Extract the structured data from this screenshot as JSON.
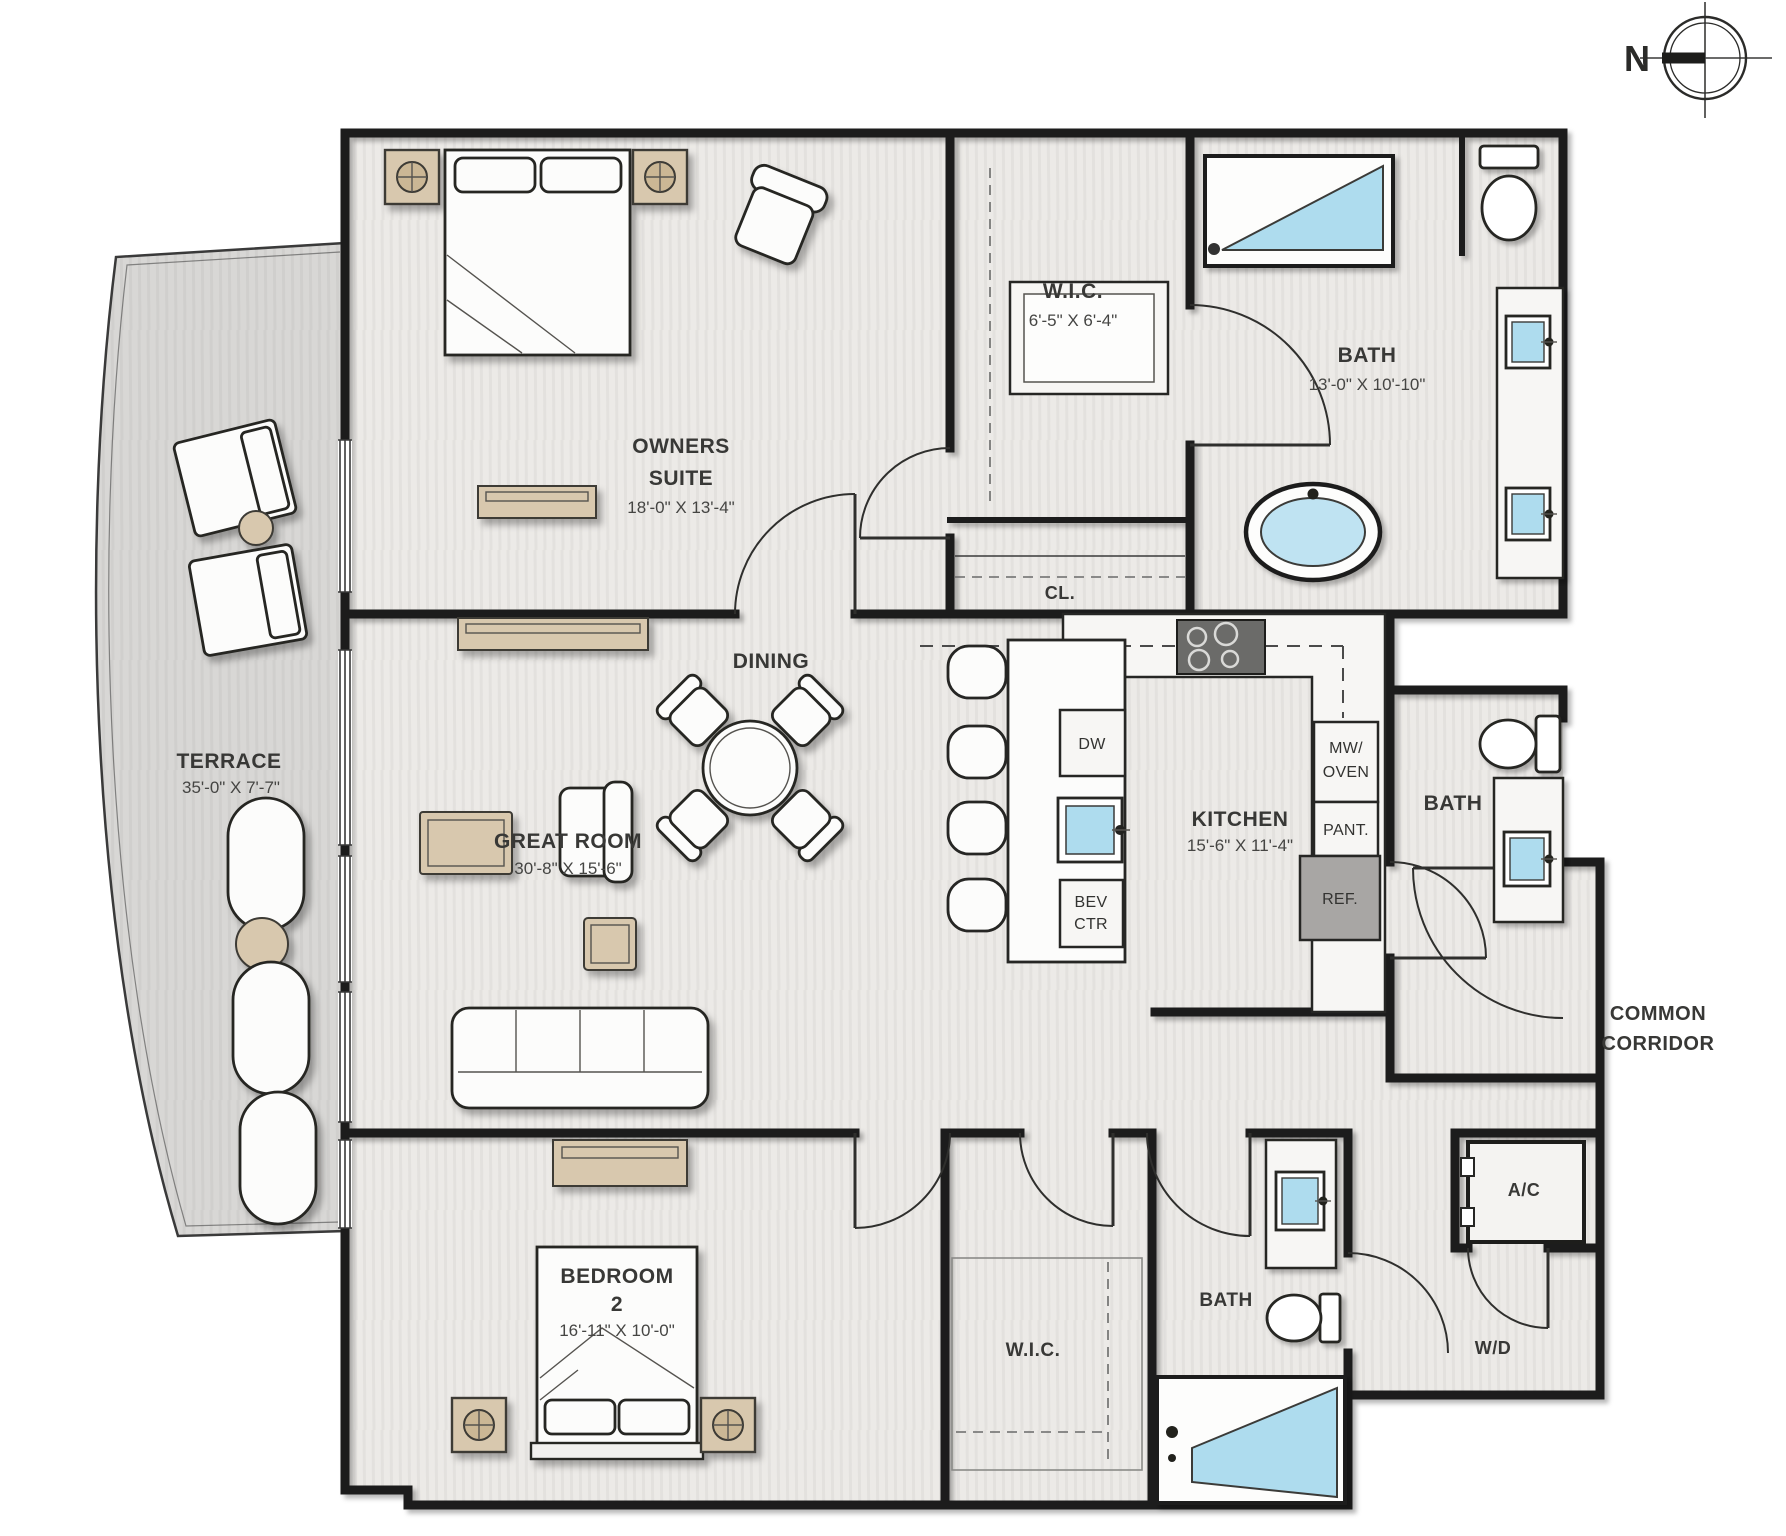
{
  "plan": {
    "compass": {
      "north": "N"
    },
    "rooms": {
      "owners_suite": {
        "line1": "OWNERS",
        "line2": "SUITE",
        "dims": "18'-0\" X 13'-4\""
      },
      "owners_wic": {
        "name": "W.I.C.",
        "dims": "6'-5\" X 6'-4\""
      },
      "owners_bath": {
        "name": "BATH",
        "dims": "13'-0\" X 10'-10\""
      },
      "closet": {
        "name": "CL."
      },
      "dining": {
        "name": "DINING"
      },
      "great_room": {
        "name": "GREAT ROOM",
        "dims": "30'-8\" X 15'-6\""
      },
      "terrace": {
        "name": "TERRACE",
        "dims": "35'-0\" X 7'-7\""
      },
      "kitchen": {
        "name": "KITCHEN",
        "dims": "15'-6\" X 11'-4\""
      },
      "powder_bath": {
        "name": "BATH"
      },
      "bedroom_2": {
        "line1": "BEDROOM",
        "line2": "2",
        "dims": "16'-11\" X 10'-0\""
      },
      "bedroom_wic": {
        "name": "W.I.C."
      },
      "bedroom_bath": {
        "name": "BATH"
      },
      "ac_closet": {
        "name": "A/C"
      },
      "laundry": {
        "name": "W/D"
      },
      "common_corridor": {
        "line1": "COMMON",
        "line2": "CORRIDOR"
      }
    },
    "kitchen_labels": {
      "dw": "DW",
      "mw1": "MW/",
      "mw2": "OVEN",
      "pant": "PANT.",
      "ref": "REF.",
      "bev1": "BEV",
      "bev2": "CTR"
    },
    "colors": {
      "wall": "#1d1d1b",
      "water": "#aedcee",
      "water_light": "#bfe3f2",
      "wood": "#d8c8ae",
      "wood_dark": "#cbb795",
      "floor": "#eceae7",
      "terrace": "#d8d7d5",
      "appliance": "#a8a6a4",
      "cooktop": "#6b6b69"
    }
  }
}
